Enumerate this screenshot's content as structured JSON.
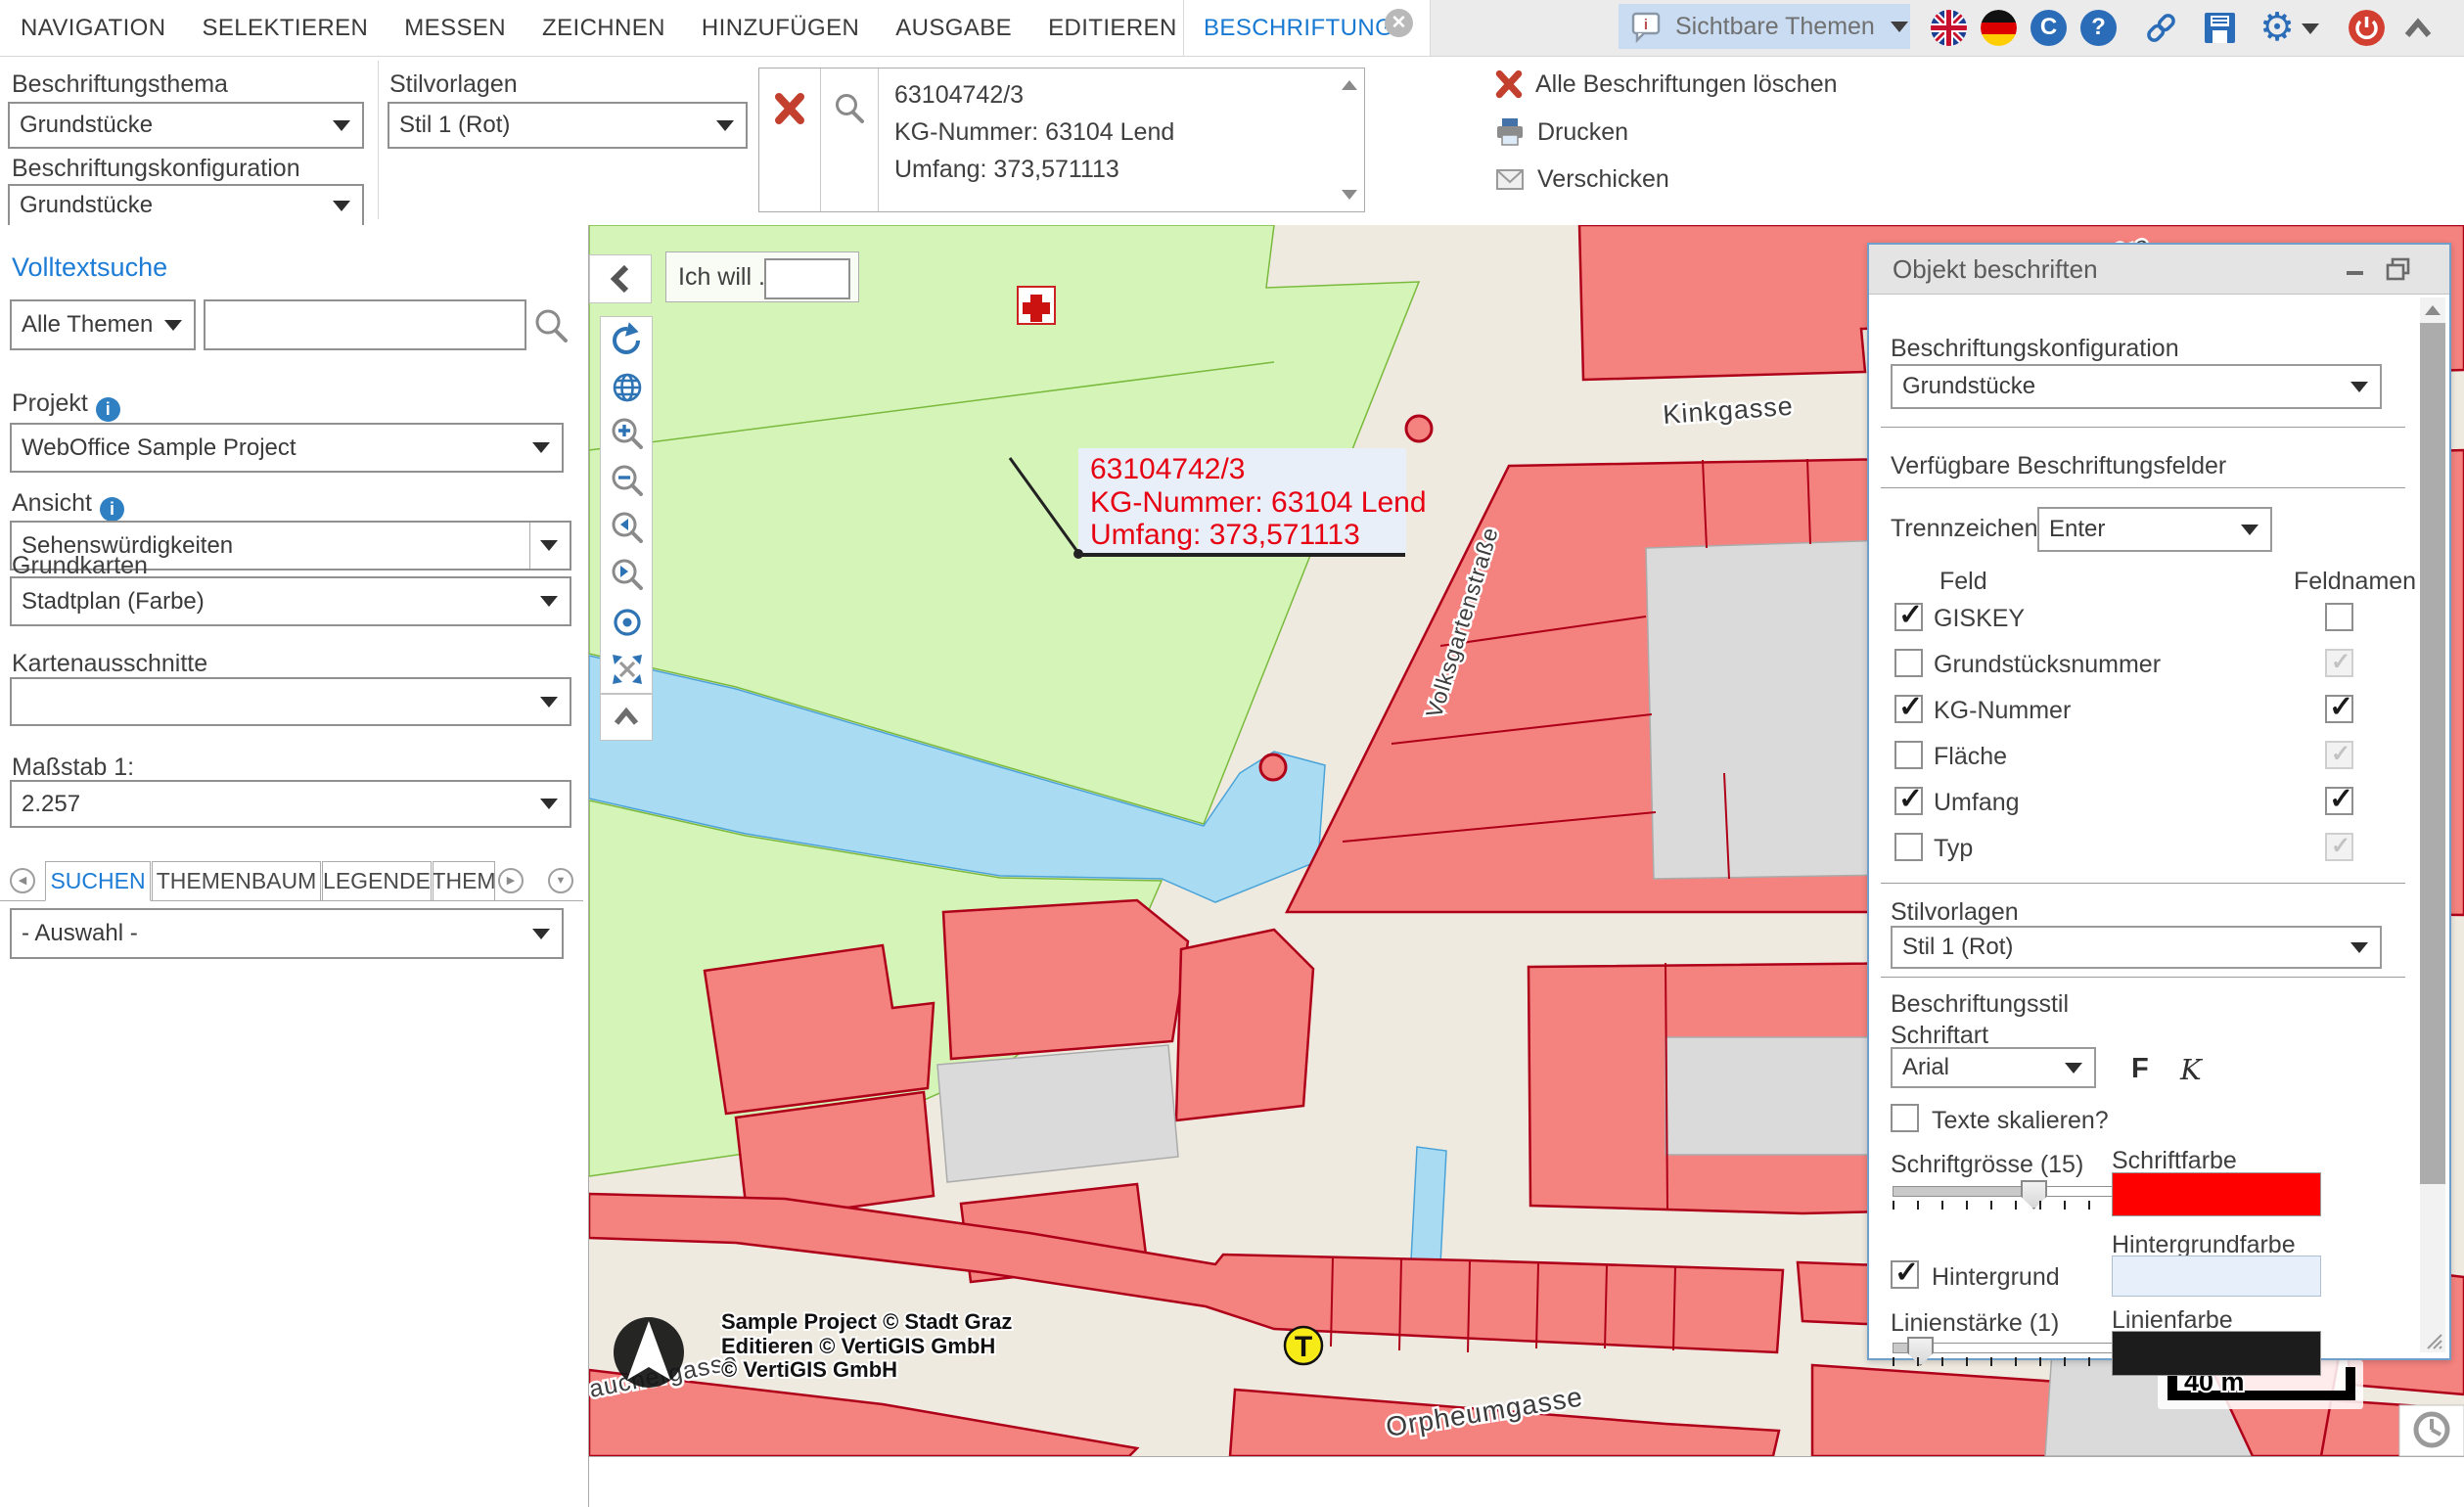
{
  "menubar": {
    "items": [
      "NAVIGATION",
      "SELEKTIEREN",
      "MESSEN",
      "ZEICHNEN",
      "HINZUFÜGEN",
      "AUSGABE",
      "EDITIEREN",
      "ANALYSE"
    ],
    "active_tab": "BESCHRIFTUNG",
    "visible_themes": "Sichtbare Themen"
  },
  "ribbon": {
    "labeling_theme_label": "Beschriftungsthema",
    "labeling_theme_value": "Grundstücke",
    "labeling_config_label": "Beschriftungskonfiguration",
    "labeling_config_value": "Grundstücke",
    "style_templates_label": "Stilvorlagen",
    "style_templates_value": "Stil 1 (Rot)",
    "result": {
      "line1": "63104742/3",
      "line2": "KG-Nummer: 63104 Lend",
      "line3": "Umfang: 373,571113"
    },
    "actions": {
      "delete_all": "Alle Beschriftungen löschen",
      "print": "Drucken",
      "send": "Verschicken"
    }
  },
  "sidebar": {
    "fulltext_search_title": "Volltextsuche",
    "all_themes_value": "Alle Themen",
    "search_value": "",
    "project_label": "Projekt",
    "project_value": "WebOffice Sample Project",
    "view_label": "Ansicht",
    "view_value": "Sehenswürdigkeiten",
    "basemaps_label": "Grundkarten",
    "basemaps_value": "Stadtplan (Farbe)",
    "map_extracts_label": "Kartenausschnitte",
    "map_extracts_value": "",
    "scale_label": "Maßstab 1:",
    "scale_value": "2.257",
    "tabs": [
      "SUCHEN",
      "THEMENBAUM",
      "LEGENDE",
      "THEM"
    ],
    "selection_value": "- Auswahl -"
  },
  "map": {
    "i_want_label": "Ich will ...",
    "i_want_value": "",
    "label_box": {
      "line1": "63104742/3",
      "line2": "KG-Nummer: 63104 Lend",
      "line3": "Umfang: 373,571113"
    },
    "streets": {
      "kinkgasse": "Kinkgasse",
      "volksgartenstrasse": "Volksgartenstraße",
      "orpheumgasse": "Orpheumgasse",
      "rauchergasse": "auchergasse",
      "top_right": "ergasse"
    },
    "copyright": {
      "line1": "Sample Project © Stadt Graz",
      "line2": "Editieren © VertiGIS GmbH",
      "line3": "© VertiGIS GmbH"
    },
    "scalebar": "40 m",
    "marker_t": "T",
    "colors": {
      "park": "#d5f4b8",
      "water": "#a9dcf2",
      "building": "#f4827e",
      "building_stroke": "#ae0019",
      "street": "#efeae0",
      "label_text": "#e60012",
      "label_bg": "#e8eff9"
    }
  },
  "panel": {
    "title": "Objekt beschriften",
    "labeling_config_label": "Beschriftungskonfiguration",
    "labeling_config_value": "Grundstücke",
    "available_fields_title": "Verfügbare Beschriftungsfelder",
    "separator_label": "Trennzeichen",
    "separator_value": "Enter",
    "col_field": "Feld",
    "col_fieldnames": "Feldnamen",
    "fields": [
      {
        "label": "GISKEY",
        "feld": "checked",
        "feldname": "unchecked"
      },
      {
        "label": "Grundstücksnummer",
        "feld": "unchecked",
        "feldname": "disabled-checked"
      },
      {
        "label": "KG-Nummer",
        "feld": "checked",
        "feldname": "checked"
      },
      {
        "label": "Fläche",
        "feld": "unchecked",
        "feldname": "disabled-checked"
      },
      {
        "label": "Umfang",
        "feld": "checked",
        "feldname": "checked"
      },
      {
        "label": "Typ",
        "feld": "unchecked",
        "feldname": "disabled-checked"
      }
    ],
    "style_templates_label": "Stilvorlagen",
    "style_templates_value": "Stil 1 (Rot)",
    "label_style_title": "Beschriftungsstil",
    "font_label": "Schriftart",
    "font_value": "Arial",
    "bold_label": "F",
    "italic_label": "K",
    "scale_texts_label": "Texte skalieren?",
    "font_size_label": "Schriftgrösse (15)",
    "font_color_label": "Schriftfarbe",
    "font_color": "#ff0000",
    "background_label": "Hintergrund",
    "background_color_label": "Hintergrundfarbe",
    "background_color": "#e7f0fa",
    "line_width_label": "Linienstärke (1)",
    "line_color_label": "Linienfarbe",
    "line_color": "#1c1c1c"
  }
}
